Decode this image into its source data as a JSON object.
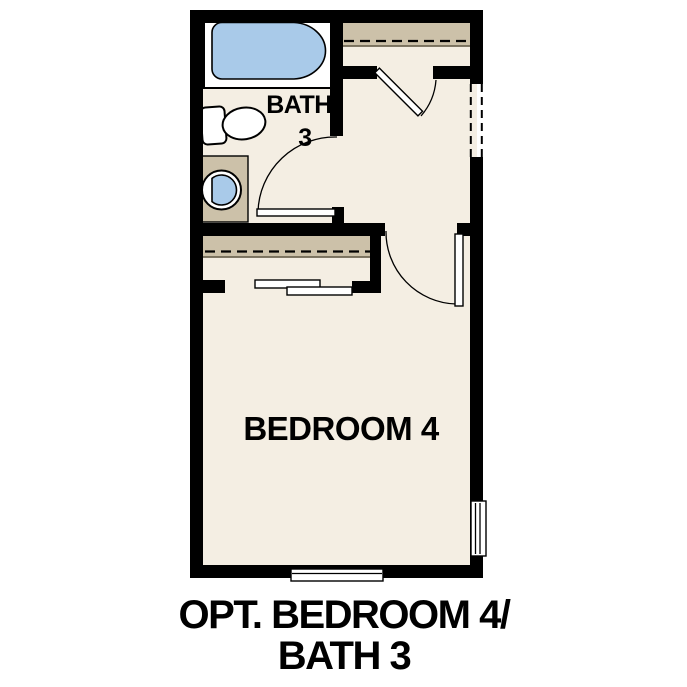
{
  "title": "OPT. BEDROOM 4 / BATH 3 floor plan",
  "labels": {
    "bath_line1": "BATH",
    "bath_line2": "3",
    "bedroom": "BEDROOM 4"
  },
  "caption": {
    "line1": "OPT. BEDROOM 4/",
    "line2": "BATH 3"
  },
  "fixtures": [
    "bathtub",
    "toilet",
    "sink-vanity",
    "closet-shelf",
    "bedroom-closet-shelf"
  ],
  "doors": [
    "bath-swing-door",
    "closet-swing-door",
    "bedroom-swing-door",
    "closet-bypass-doors"
  ],
  "windows": [
    "right-wall-window",
    "bottom-wall-window"
  ],
  "openings": [
    "dashed-wall-opening"
  ],
  "colors": {
    "wall": "#000000",
    "floor": "#F4EEE3",
    "shelf_tan": "#CCC1A9",
    "shelf_edge": "#6F6754",
    "fixture_blue": "#A9CAE9",
    "white": "#FFFFFF",
    "text": "#000000"
  }
}
